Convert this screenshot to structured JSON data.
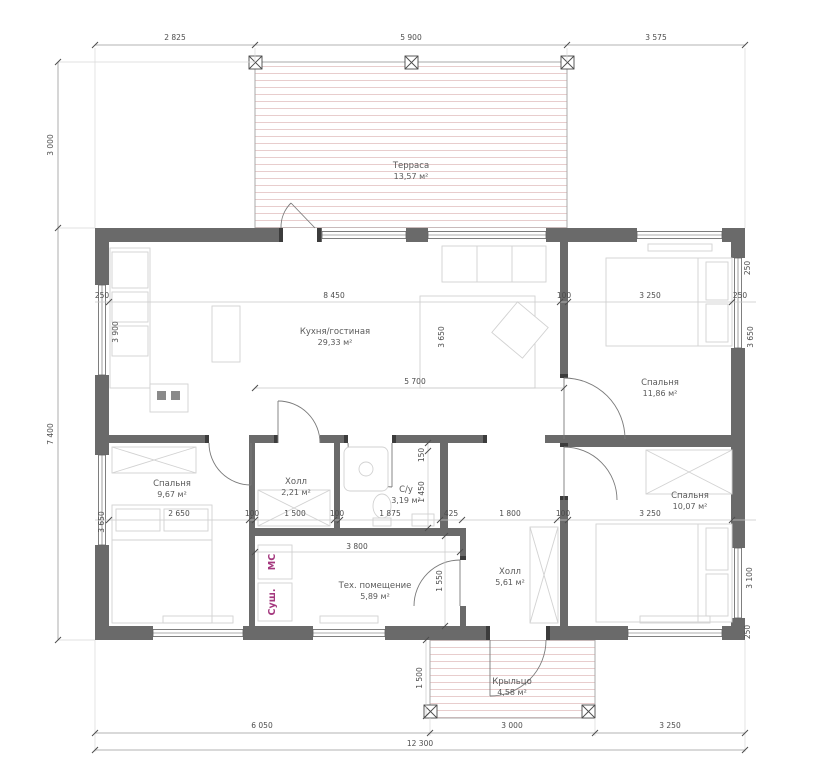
{
  "document": {
    "type": "architectural-floor-plan",
    "language": "ru"
  },
  "rooms": [
    {
      "id": "terrace",
      "name": "Терраса",
      "area": "13,57 м²"
    },
    {
      "id": "kitchen",
      "name": "Кухня/гостиная",
      "area": "29,33 м²"
    },
    {
      "id": "bedroom1",
      "name": "Спальня",
      "area": "11,86 м²"
    },
    {
      "id": "bedroom2",
      "name": "Спальня",
      "area": "9,67 м²"
    },
    {
      "id": "hall1",
      "name": "Холл",
      "area": "2,21 м²"
    },
    {
      "id": "bath",
      "name": "С/у",
      "area": "3,19 м²"
    },
    {
      "id": "hall2",
      "name": "Холл",
      "area": "5,61 м²"
    },
    {
      "id": "bedroom3",
      "name": "Спальня",
      "area": "10,07 м²"
    },
    {
      "id": "tech",
      "name": "Тех. помещение",
      "area": "5,89 м²"
    },
    {
      "id": "porch",
      "name": "Крыльцо",
      "area": "4,58 м²"
    }
  ],
  "dimensions": {
    "top": [
      "2 825",
      "5 900",
      "3 575"
    ],
    "left": [
      "3 000",
      "7 400"
    ],
    "bottom": [
      "6 050",
      "3 000",
      "3 250"
    ],
    "total_width": "12 300",
    "row1": [
      "250",
      "8 450",
      "100",
      "3 250",
      "250"
    ],
    "row1_vertical": [
      "3 900",
      "3 650",
      "3 650",
      "250",
      "250"
    ],
    "mid": "5 700",
    "row3": [
      "2 650",
      "100",
      "1 500",
      "100",
      "1 875",
      "425",
      "1 800",
      "100",
      "3 250"
    ],
    "row3_vertical": [
      "3 650",
      "3 100"
    ],
    "bath_vertical": [
      "150",
      "1 450"
    ],
    "tech": [
      "3 800",
      "1 550"
    ],
    "porch_vertical": "1 500"
  },
  "appliances": {
    "washer": "МС",
    "dryer": "Суш."
  },
  "colors": {
    "wall": "#6a6a6a",
    "dim_text": "#4d4d4d",
    "hatch": "#e8cdcd",
    "appliance_label": "#a4387e",
    "furniture": "#d2d2d2"
  }
}
